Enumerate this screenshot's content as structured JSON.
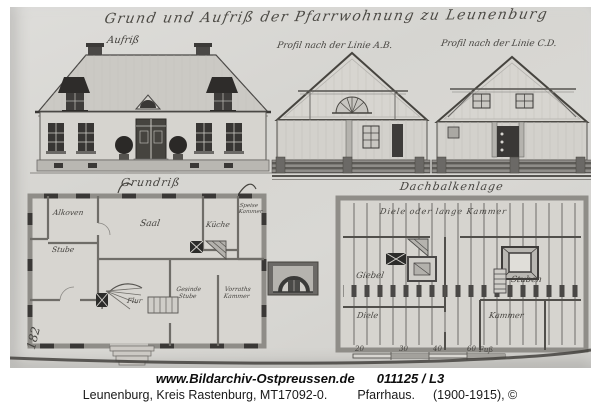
{
  "drawing": {
    "title": "Grund und Aufriß der Pfarrwohnung zu Leunenburg",
    "elevation_label": "Aufriß",
    "section_ab_label": "Profil nach der Linie A.B.",
    "section_cd_label": "Profil nach der Linie C.D.",
    "ground_plan": {
      "label": "Grundriß",
      "rooms": {
        "alkoven": "Alkoven",
        "saal": "Saal",
        "kueche": "Küche",
        "speisekammer": "Speise Kammer",
        "stube": "Stube",
        "flur": "Flur",
        "gesindestube": "Gesinde Stube",
        "vorrathskammer": "Vorraths Kammer"
      }
    },
    "attic_plan": {
      "label": "Dachbalkenlage",
      "rooms": {
        "lange_kammer": "Diele oder lange Kammer",
        "giebel": "Giebel",
        "stuben": "Stuben",
        "diele": "Diele",
        "kammer": "Kammer"
      }
    },
    "scale_bar": {
      "ticks": [
        "20",
        "30",
        "40",
        "60"
      ],
      "unit": "Fuß"
    },
    "sheet_number": "182"
  },
  "caption": {
    "url": "www.Bildarchiv-Ostpreussen.de",
    "image_id": "011125 / L3",
    "location": "Leunenburg, Kreis Rastenburg, MT17092-0.",
    "building": "Pfarrhaus.",
    "date": "(1900-1915), ©"
  },
  "colors": {
    "paper": "#d7d6d2",
    "ink": "#45433f",
    "caption_text": "#111111"
  }
}
